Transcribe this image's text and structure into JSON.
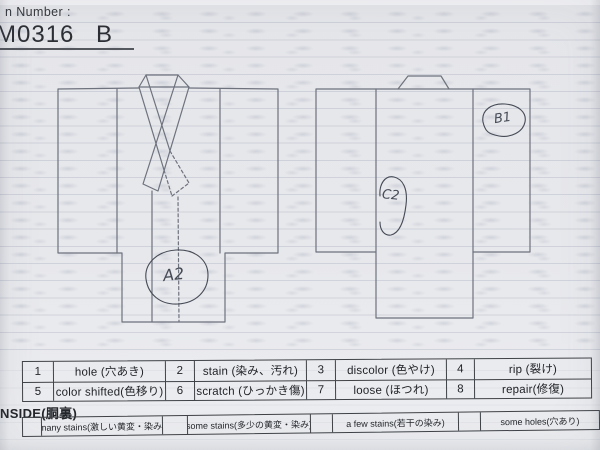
{
  "header": {
    "form_label": "n Number :",
    "item_number": "M0316 B"
  },
  "annotations": {
    "front_body": "A2",
    "back_sleeve": "B1",
    "back_body": "C2"
  },
  "defect_table": {
    "rows": [
      [
        {
          "code": "1",
          "label": "hole (穴あき)"
        },
        {
          "code": "2",
          "label": "stain (染み、汚れ)"
        },
        {
          "code": "3",
          "label": "discolor (色やけ)"
        },
        {
          "code": "4",
          "label": "rip (裂け)"
        }
      ],
      [
        {
          "code": "5",
          "label": "color shifted(色移り)"
        },
        {
          "code": "6",
          "label": "scratch (ひっかき傷)"
        },
        {
          "code": "7",
          "label": "loose (ほつれ)"
        },
        {
          "code": "8",
          "label": "repair(修復)"
        }
      ]
    ]
  },
  "inside_section": {
    "title": "NSIDE(胴裏)",
    "options": [
      "many stains(激しい黄変・染み)",
      "some stains(多少の黄変・染み)",
      "a few stains(若干の染み)",
      "some holes(穴あり)"
    ]
  },
  "colors": {
    "paper": "#e7e8ec",
    "diagram_line": "#6e727d",
    "table_border": "#3f4247",
    "ink": "#23262b",
    "handwriting": "#454a55"
  }
}
